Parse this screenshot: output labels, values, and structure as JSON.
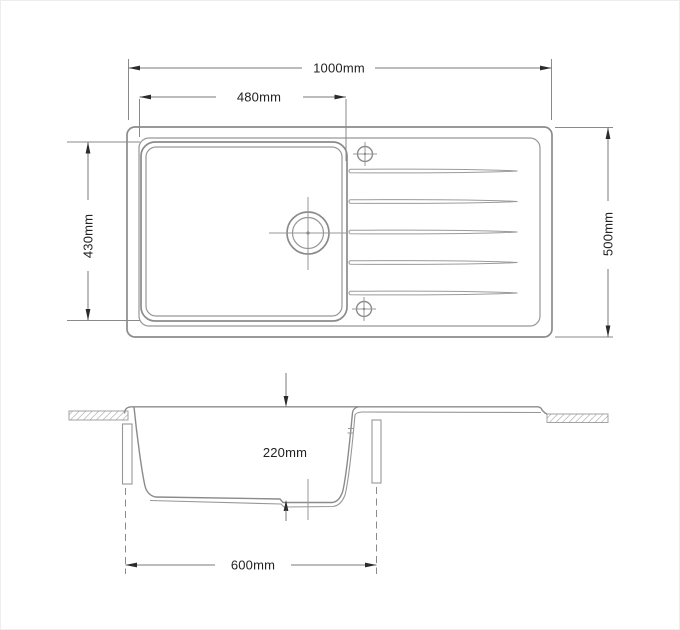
{
  "drawing": {
    "dimensions": {
      "overall_length": "1000mm",
      "bowl_width": "480mm",
      "bowl_front_to_back": "430mm",
      "overall_depth": "500mm",
      "bowl_depth": "220mm",
      "base_width": "600mm"
    },
    "colors": {
      "background": "#ffffff",
      "drawing_line": "#8b8b8b",
      "dimension_line": "#7a7a7a",
      "arrowhead": "#2b2b2b",
      "text": "#222222",
      "hatch": "#9a9a9a"
    }
  }
}
